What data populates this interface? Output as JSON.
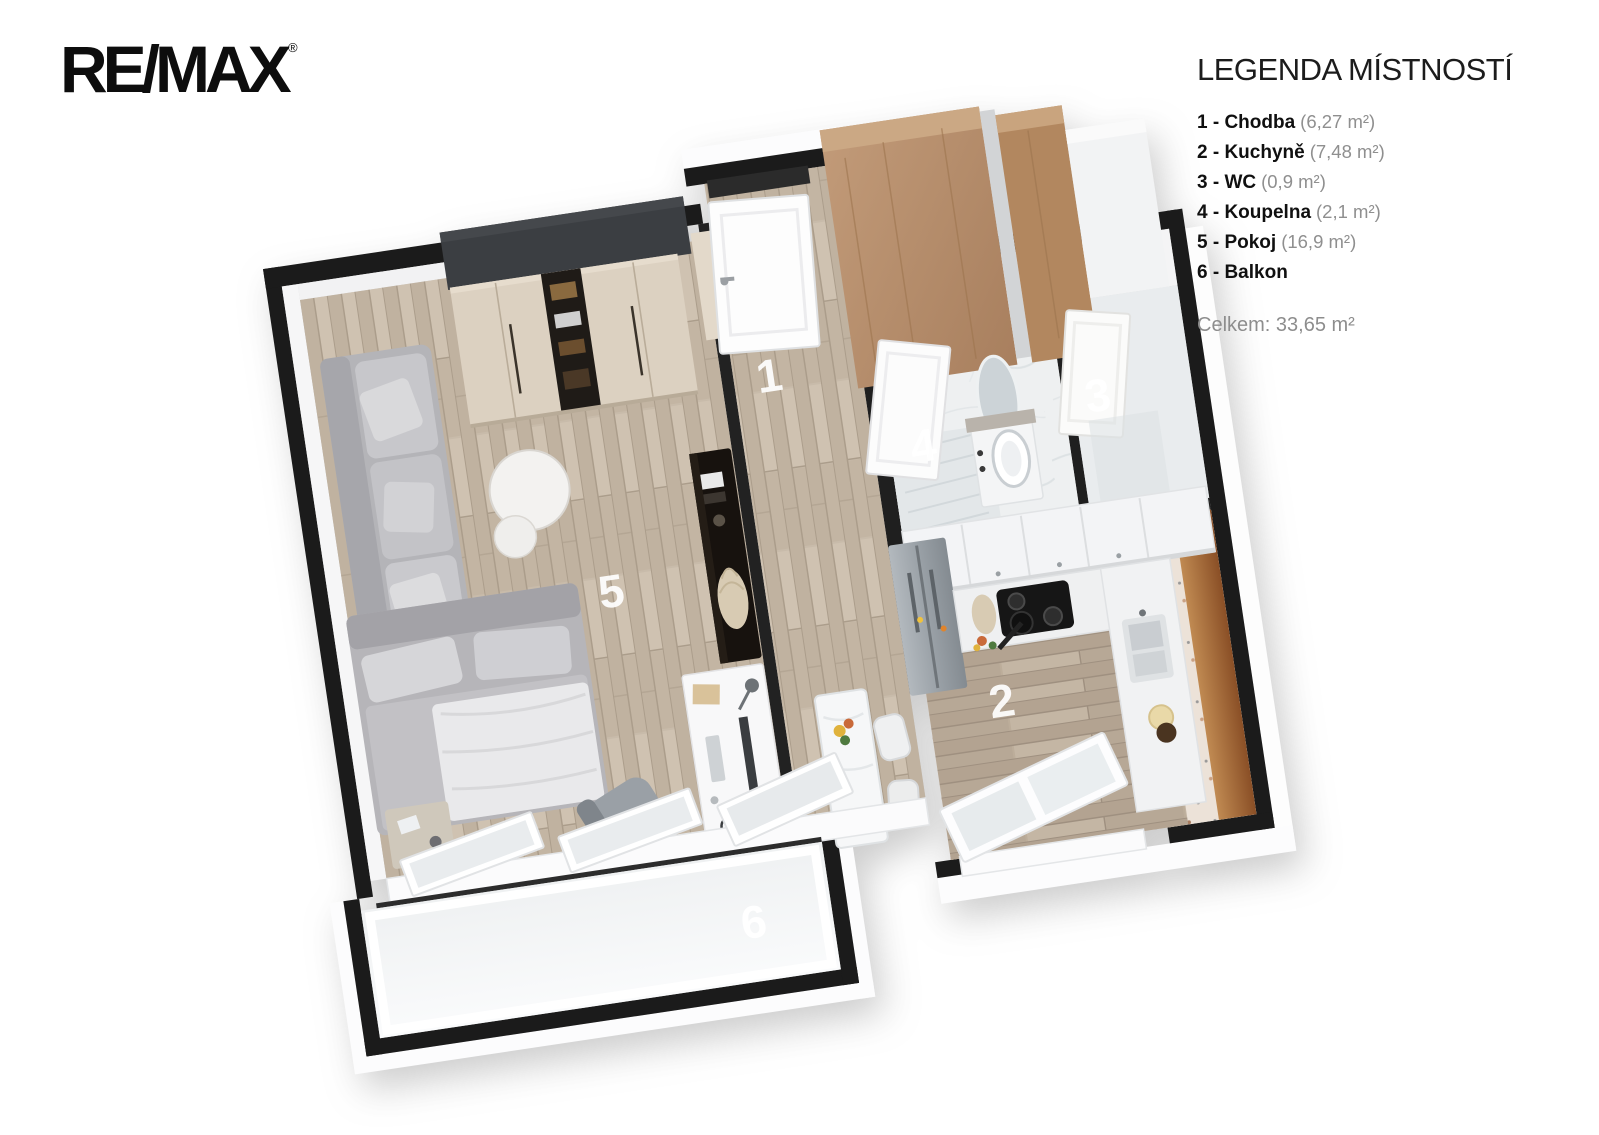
{
  "logo": {
    "text": "RE/MAX",
    "registered": "®"
  },
  "legend": {
    "title": "LEGENDA MÍSTNOSTÍ",
    "items": [
      {
        "label": "1 - Chodba",
        "area": "(6,27 m²)"
      },
      {
        "label": "2 - Kuchyně",
        "area": "(7,48 m²)"
      },
      {
        "label": "3 - WC",
        "area": "(0,9 m²)"
      },
      {
        "label": "4 - Koupelna",
        "area": "(2,1 m²)"
      },
      {
        "label": "5 - Pokoj",
        "area": "(16,9 m²)"
      },
      {
        "label": "6 - Balkon",
        "area": ""
      }
    ],
    "total": "Celkem: 33,65 m²"
  },
  "floorplan": {
    "room_labels": [
      "1",
      "2",
      "3",
      "4",
      "5",
      "6"
    ],
    "rooms": [
      {
        "num": "1",
        "name": "Chodba"
      },
      {
        "num": "2",
        "name": "Kuchyně"
      },
      {
        "num": "3",
        "name": "WC"
      },
      {
        "num": "4",
        "name": "Koupelna"
      },
      {
        "num": "5",
        "name": "Pokoj"
      },
      {
        "num": "6",
        "name": "Balkon"
      }
    ],
    "colors": {
      "wall": "#1b1b1b",
      "charcoal_closet": "#3b3e42",
      "wood_floor": "#c8bbaa",
      "kitchen_wood": "#b9a994",
      "wardrobe_cream": "#dcd1c1",
      "wardrobe_wood": "#b78e6f",
      "marble": "#eef0f1",
      "terrazzo": "#eadfd5",
      "balcony_floor": "#f5f6f7",
      "counter_wood": "#a9642f"
    }
  }
}
